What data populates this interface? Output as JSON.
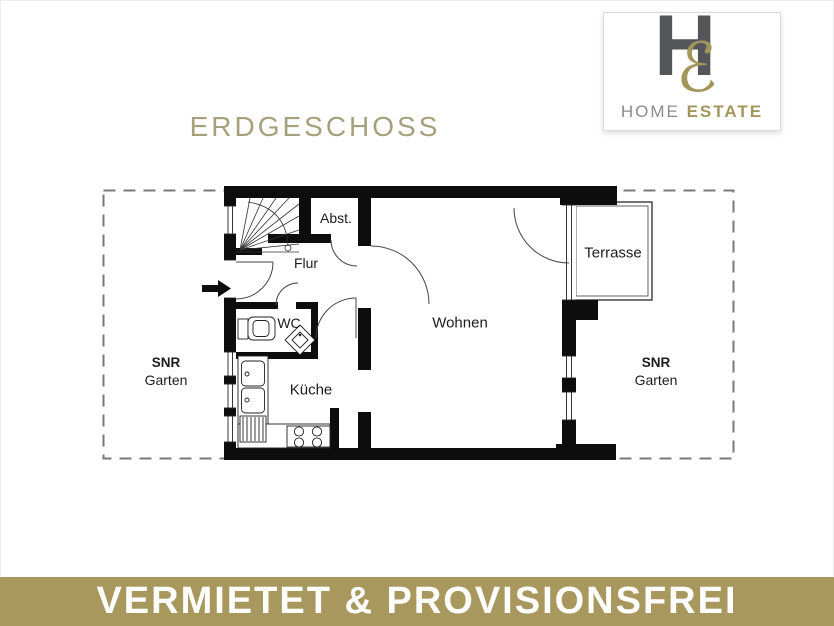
{
  "page_title": "ERDGESCHOSS",
  "logo": {
    "monogram_h": "H",
    "monogram_e": "ℰ",
    "word_home": "HOME",
    "word_estate": "ESTATE"
  },
  "floorplan": {
    "rooms": {
      "abst": "Abst.",
      "flur": "Flur",
      "wc": "WC",
      "kueche": "Küche",
      "wohnen": "Wohnen",
      "terrasse": "Terrasse"
    },
    "garden_left": {
      "line1": "SNR",
      "line2": "Garten"
    },
    "garden_right": {
      "line1": "SNR",
      "line2": "Garten"
    }
  },
  "banner": {
    "text": "VERMIETET & PROVISIONSFREI"
  },
  "colors": {
    "banner_gold": "#a8985d",
    "title_gold": "#a6a17c",
    "logo_gray": "#55565a",
    "logo_gold": "#a3965c",
    "banner_text": "#ffffff",
    "plan_line": "#0d0d0d",
    "garden_dash": "#787878"
  }
}
